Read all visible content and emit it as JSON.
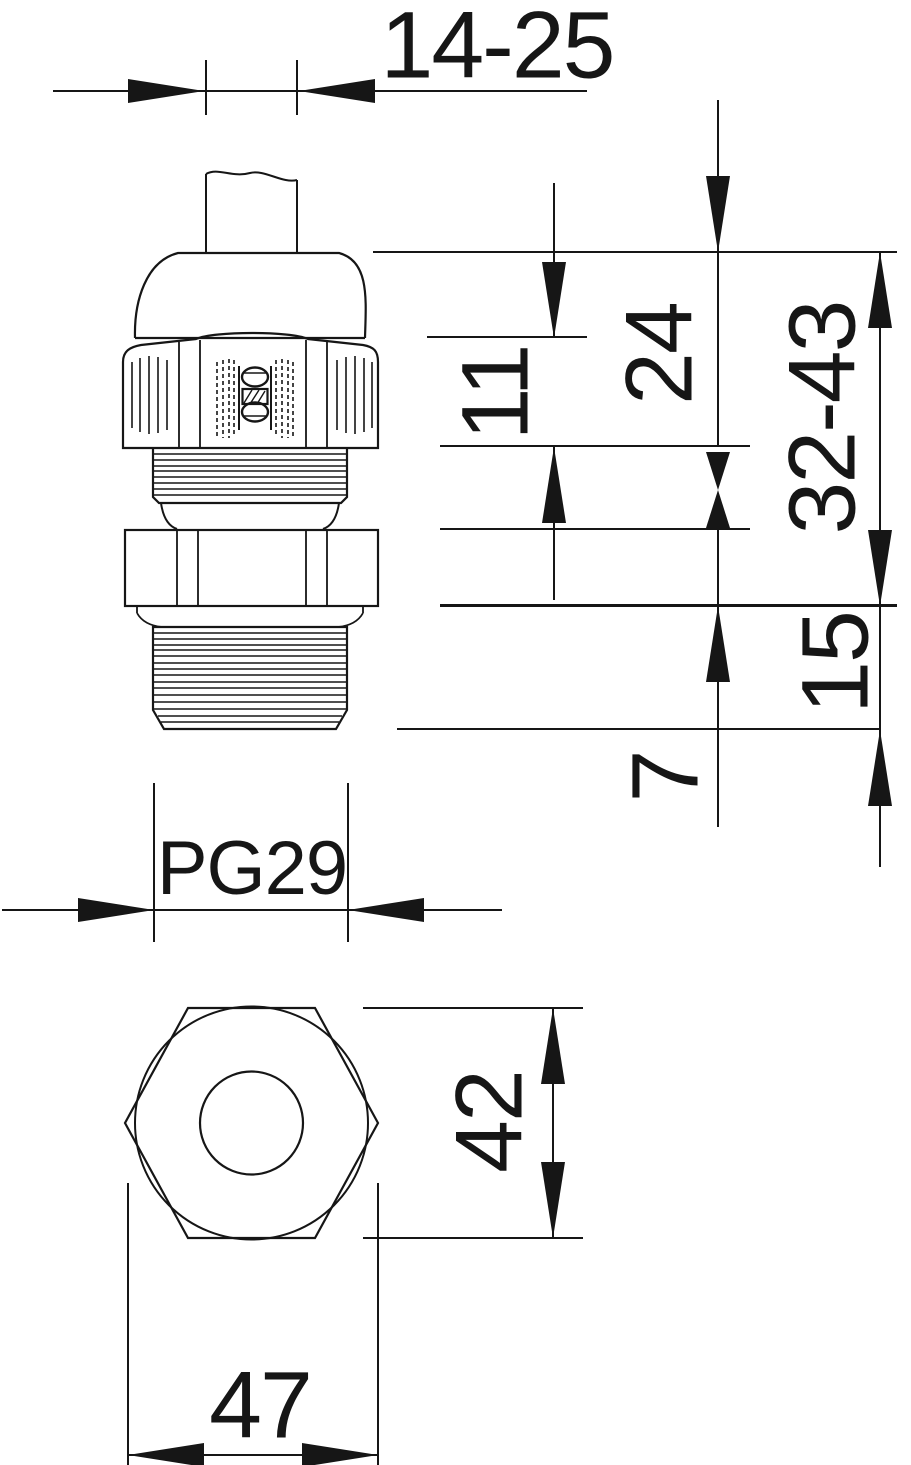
{
  "page": {
    "background": "#ffffff",
    "ink": "#161616"
  },
  "drawing": {
    "kind": "technical-drawing-cable-gland",
    "icons": {
      "logo": "obo-logo"
    }
  },
  "dims": {
    "clamping_range": {
      "label": "14-25"
    },
    "cap_height": {
      "label": "11"
    },
    "upper_section": {
      "label": "24"
    },
    "overall_range": {
      "label": "32-43"
    },
    "thread_length": {
      "label": "15"
    },
    "locknut_height": {
      "label": "7"
    },
    "thread_size": {
      "label": "PG29"
    },
    "across_flats": {
      "label": "42"
    },
    "across_corners": {
      "label": "47"
    }
  }
}
